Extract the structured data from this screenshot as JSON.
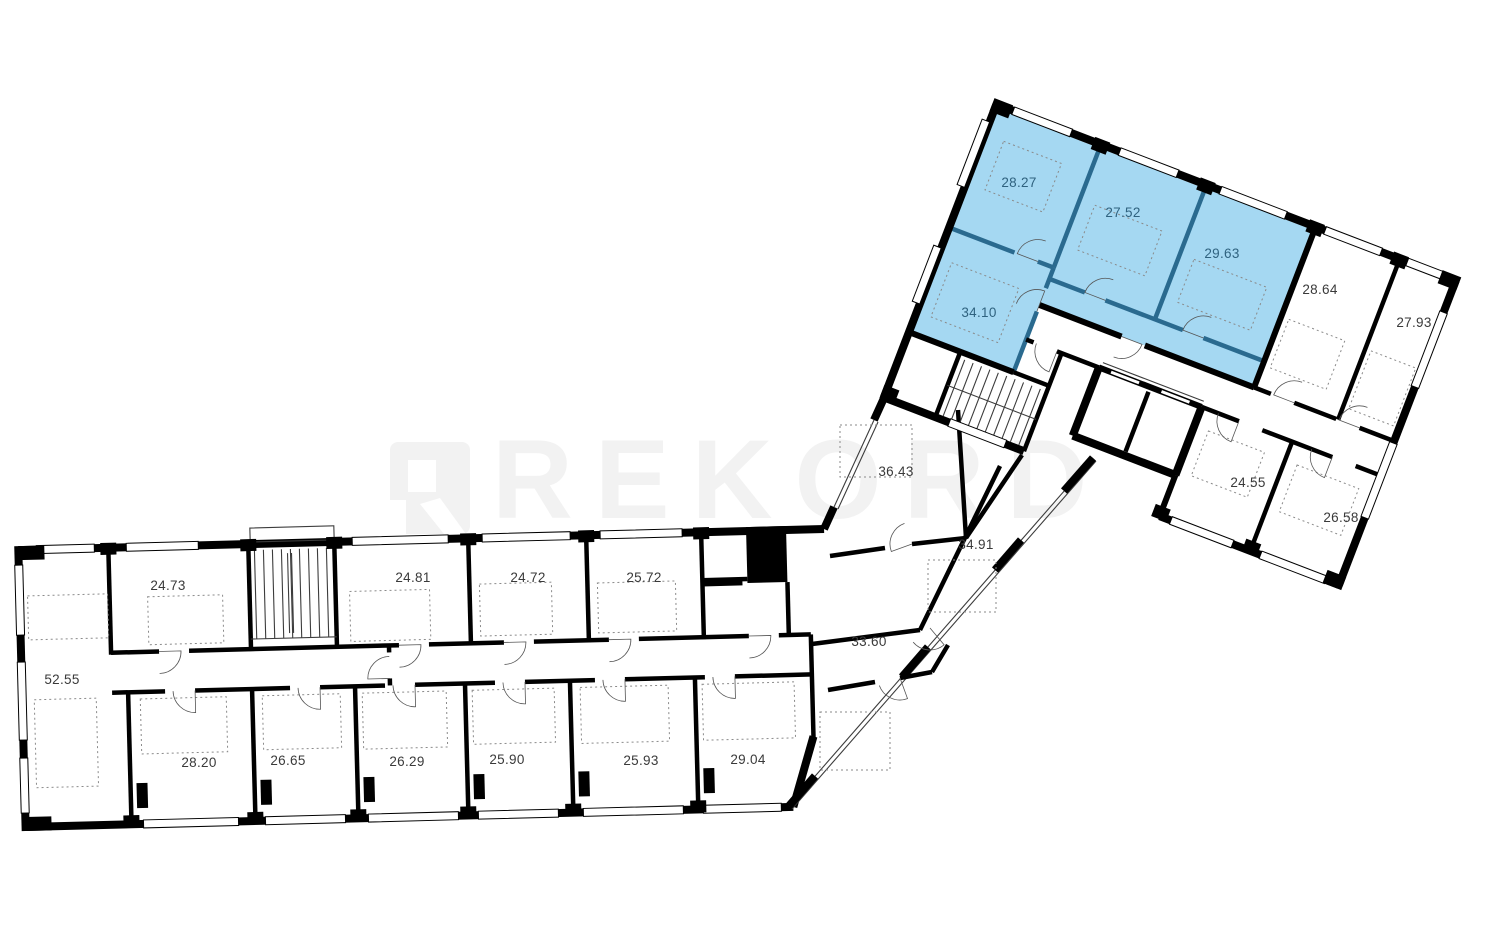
{
  "watermark": {
    "text": "REKORD"
  },
  "colors": {
    "highlight_fill": "#a5d8f2",
    "highlight_wall": "#2a6a8f",
    "wall": "#000000",
    "label": "#3a3a3a",
    "highlight_label": "#2f627f",
    "watermark": "#f2f2f2"
  },
  "apartment": {
    "highlighted_room_areas": [
      "28.27",
      "27.52",
      "29.63",
      "34.10"
    ]
  },
  "rooms": {
    "a5255": {
      "area": "52.55"
    },
    "a2473": {
      "area": "24.73"
    },
    "a2481": {
      "area": "24.81"
    },
    "a2472": {
      "area": "24.72"
    },
    "a2572": {
      "area": "25.72"
    },
    "a2820": {
      "area": "28.20"
    },
    "a2665": {
      "area": "26.65"
    },
    "a2629": {
      "area": "26.29"
    },
    "a2590": {
      "area": "25.90"
    },
    "a2593": {
      "area": "25.93"
    },
    "a2904": {
      "area": "29.04"
    },
    "a3643": {
      "area": "36.43"
    },
    "a3491": {
      "area": "34.91"
    },
    "a3360": {
      "area": "33.60"
    },
    "a3410": {
      "area": "34.10"
    },
    "a2827": {
      "area": "28.27"
    },
    "a2752": {
      "area": "27.52"
    },
    "a2963": {
      "area": "29.63"
    },
    "a2864": {
      "area": "28.64"
    },
    "a2793": {
      "area": "27.93"
    },
    "a2455": {
      "area": "24.55"
    },
    "a2658": {
      "area": "26.58"
    }
  }
}
